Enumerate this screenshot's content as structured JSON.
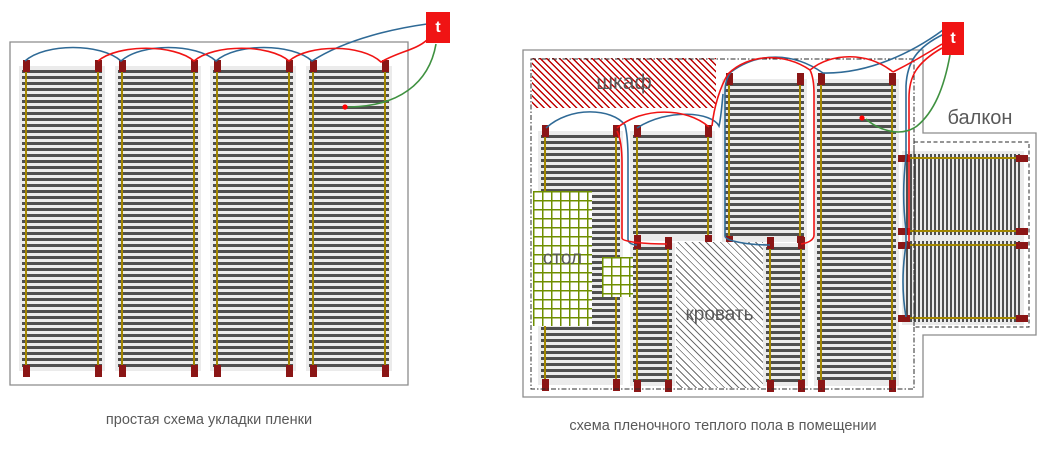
{
  "colors": {
    "wire_blue": "#2f6a96",
    "wire_red": "#f01414",
    "wire_green": "#3f9140",
    "terminal": "#8b1616",
    "busbar": "#a38700",
    "bar": "#4f4f4f",
    "strip_bg": "#ebebeb",
    "outer_border": "#8c8c8c",
    "inner_border": "#2b2b2b",
    "hatch_red": "#c00000",
    "hatch_gray": "#6e6e6e",
    "grid_green": "#6f8f00",
    "thermostat_bg": "#f01414",
    "thermostat_text": "#ffffff",
    "label_color": "#595959",
    "sensor": "#ff0000"
  },
  "left_diagram": {
    "caption": "простая схема укладки пленки",
    "thermostat": {
      "label": "t"
    },
    "border_path": "M10,42 H408 V385 H10 Z",
    "strips": [
      {
        "x": 19,
        "y": 66,
        "w": 86,
        "h": 305,
        "dir": "v"
      },
      {
        "x": 115,
        "y": 66,
        "w": 86,
        "h": 305,
        "dir": "v"
      },
      {
        "x": 210,
        "y": 66,
        "w": 86,
        "h": 305,
        "dir": "v"
      },
      {
        "x": 306,
        "y": 66,
        "w": 86,
        "h": 305,
        "dir": "v"
      }
    ],
    "sensor": {
      "x": 345,
      "y": 107
    },
    "wires": {
      "blue": [
        "M25,61 C45,43 101,43 121,61 C141,43 196,43 216,61 C236,43 292,43 312,61 C348,38 398,28 427,24"
      ],
      "red": [
        "M98,61 C118,44 174,44 194,61 C214,44 269,44 289,61 C309,44 362,44 381,62 C398,52 416,50 427,40"
      ],
      "green": [
        "M436,44 C429,84 398,106 350,107 L348,107"
      ]
    }
  },
  "right_diagram": {
    "caption": "схема пленочного теплого пола в помещении",
    "thermostat": {
      "label": "t"
    },
    "outline_path": "M523,50 H923 V133 H1036 V335 H923 V397 H523 Z",
    "inner_border": {
      "x": 531,
      "y": 59,
      "w": 383,
      "h": 330
    },
    "balcony_border": {
      "x": 914,
      "y": 142,
      "w": 115,
      "h": 185
    },
    "furniture": [
      {
        "type": "hatch-red",
        "label": "шкаф",
        "x": 532,
        "y": 58,
        "w": 184,
        "h": 50
      },
      {
        "type": "grid",
        "label": "стол",
        "x": 533,
        "y": 191,
        "w": 59,
        "h": 135
      },
      {
        "type": "grid",
        "x": 602,
        "y": 257,
        "w": 31,
        "h": 40
      },
      {
        "type": "hatch-gray",
        "label": "кровать",
        "x": 676,
        "y": 242,
        "w": 87,
        "h": 146
      },
      {
        "type": "area-label",
        "label": "балкон",
        "x": 930,
        "y": 105,
        "w": 100,
        "h": 26
      }
    ],
    "strips": [
      {
        "x": 538,
        "y": 131,
        "w": 85,
        "h": 254,
        "dir": "v"
      },
      {
        "x": 630,
        "y": 131,
        "w": 85,
        "h": 110,
        "dir": "v"
      },
      {
        "x": 722,
        "y": 79,
        "w": 85,
        "h": 163,
        "dir": "v"
      },
      {
        "x": 814,
        "y": 79,
        "w": 85,
        "h": 307,
        "dir": "v"
      },
      {
        "x": 630,
        "y": 243,
        "w": 45,
        "h": 143,
        "dir": "v"
      },
      {
        "x": 763,
        "y": 243,
        "w": 45,
        "h": 143,
        "dir": "v"
      },
      {
        "x": 902,
        "y": 151,
        "w": 122,
        "h": 87,
        "dir": "h"
      },
      {
        "x": 902,
        "y": 238,
        "w": 122,
        "h": 87,
        "dir": "h"
      }
    ],
    "sensor": {
      "x": 862,
      "y": 118
    },
    "wires": {
      "blue": [
        "M943,30 C913,52 869,74 823,73 C793,52 758,52 731,72 C727,77 725,83 725,92 L725,236 C725,241 748,245 770,245",
        "M637,128 C668,108 712,112 719,126 C721,118 722,104 723,94",
        "M546,128 C570,106 612,108 625,125 C627,133 628,142 628,158 L628,239 C628,243 632,245 637,245",
        "M944,34 C917,47 907,62 906,86 L906,157 C903,181 903,207 906,230 L906,245 C902,270 902,294 906,317"
      ],
      "red": [
        "M942,44 C917,60 901,68 893,72",
        "M893,72 C868,52 832,52 810,70 C813,76 814,83 814,94 L814,235 C814,240 808,243 801,244",
        "M810,70 C784,52 748,54 728,74 C720,87 714,107 712,126",
        "M617,131 C620,137 622,147 622,163 L622,238 C622,242 646,244 667,244",
        "M617,128 C642,107 686,107 709,127",
        "M942,48 C916,63 909,77 909,98 L909,242"
      ],
      "green": [
        "M950,55 C944,88 934,112 917,126 C899,139 876,128 866,119"
      ]
    }
  }
}
